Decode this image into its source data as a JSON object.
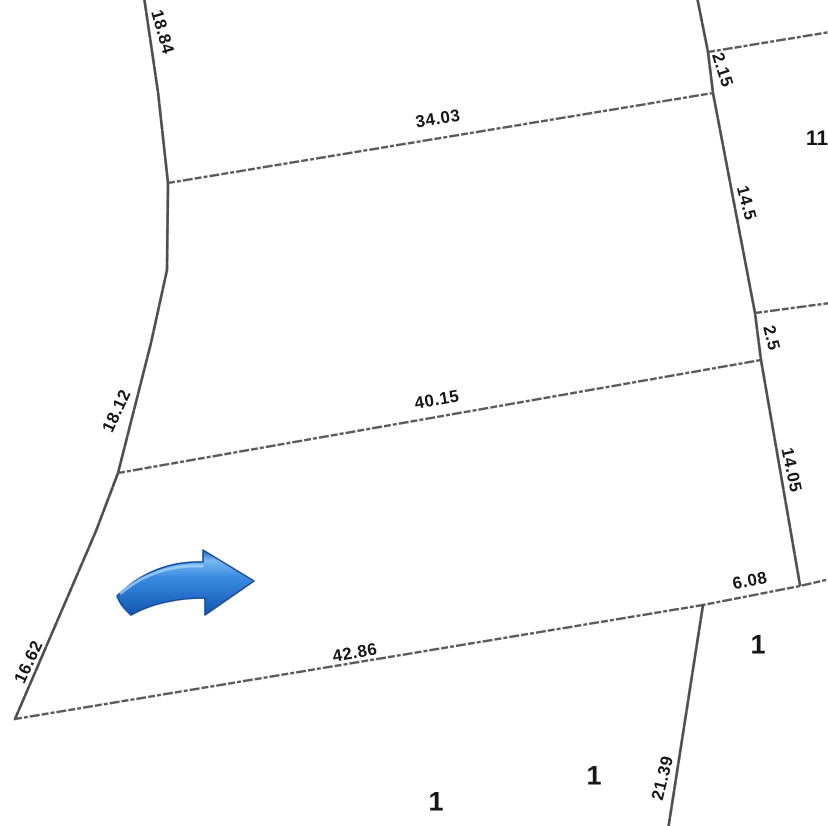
{
  "colors": {
    "background": "#ffffff",
    "line-color": "#4f4f4f",
    "line-color-light": "#5a5a5a",
    "label-color": "#161616",
    "arrow-blue": "#2e86de",
    "arrow-blue-dark": "#1256b2",
    "arrow-blue-light": "#7ab8ef"
  },
  "dimensions": {
    "d18_84": "18.84",
    "d34_03": "34.03",
    "d2_15": "2.15",
    "d14_5": "14.5",
    "d2_5": "2.5",
    "d40_15": "40.15",
    "d18_12": "18.12",
    "d14_05": "14.05",
    "d6_08": "6.08",
    "d42_86": "42.86",
    "d16_62": "16.62",
    "d21_39": "21.39"
  },
  "parcels": {
    "p11": "11",
    "p1_right": "1",
    "p1_mid": "1",
    "p1_bottom": "1"
  },
  "annotations": {
    "arrow": "blue-right-arrow"
  }
}
